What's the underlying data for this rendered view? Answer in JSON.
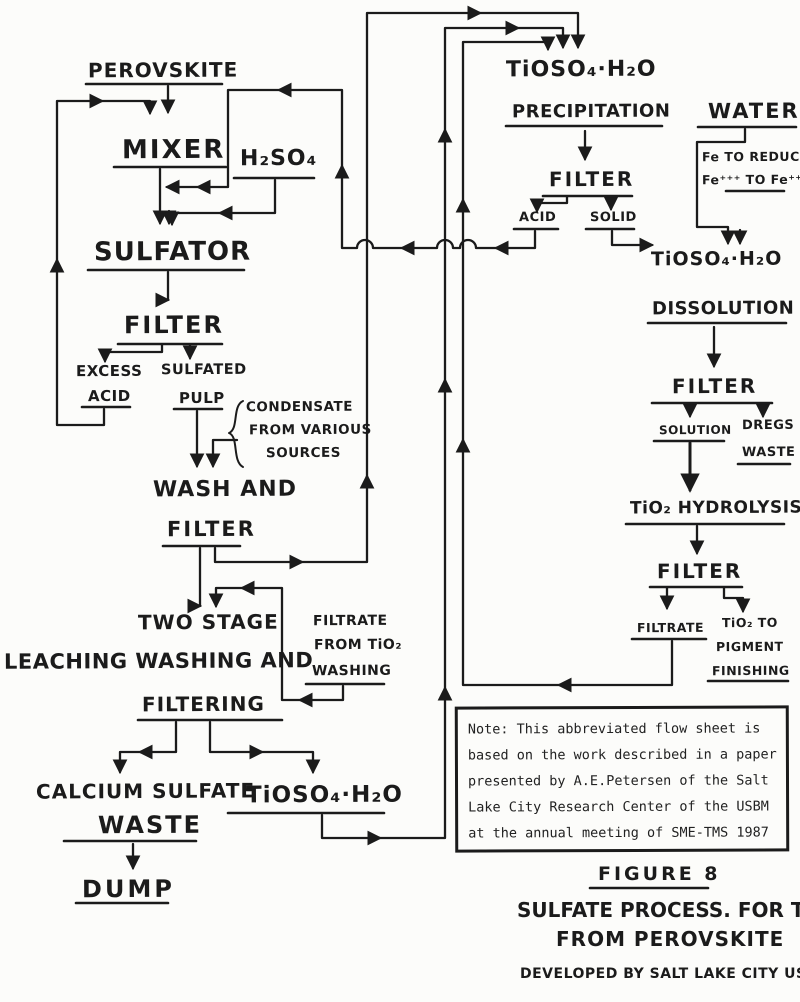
{
  "colors": {
    "ink": "#1b1b1b",
    "paper": "#fcfcfa"
  },
  "nodes": {
    "perovskite": "PEROVSKITE",
    "mixer": "MIXER",
    "h2so4": "H₂SO₄",
    "sulfator": "SULFATOR",
    "filter_sulfator": "FILTER",
    "excess": "EXCESS",
    "excess_acid": "ACID",
    "sulfated": "SULFATED",
    "pulp": "PULP",
    "condensate_1": "CONDENSATE",
    "condensate_2": "FROM VARIOUS",
    "condensate_3": "SOURCES",
    "wash_1": "WASH AND",
    "wash_2": "FILTER",
    "two_stage_1": "TWO STAGE",
    "two_stage_2": "LEACHING WASHING AND",
    "two_stage_3": "FILTERING",
    "filtrate_wash_1": "FILTRATE",
    "filtrate_wash_2": "FROM TiO₂",
    "filtrate_wash_3": "WASHING",
    "calcium_1": "CALCIUM SULFATE",
    "calcium_2": "WASTE",
    "dump": "DUMP",
    "tioso4_leach": "TiOSO₄·H₂O",
    "tioso4_precip_1": "TiOSO₄·H₂O",
    "tioso4_precip_2": "PRECIPITATION",
    "filter_precip": "FILTER",
    "acid_precip": "ACID",
    "solid": "SOLID",
    "water": "WATER",
    "fe_note_1": "Fe TO REDUCE",
    "fe_note_2": "Fe⁺⁺⁺ TO Fe⁺⁺",
    "tioso4_diss_1": "TiOSO₄·H₂O",
    "tioso4_diss_2": "DISSOLUTION",
    "filter_diss": "FILTER",
    "solution": "SOLUTION",
    "dregs_1": "DREGS",
    "dregs_2": "WASTE",
    "hydrolysis": "TiO₂ HYDROLYSIS",
    "filter_hydrolysis": "FILTER",
    "filtrate_hyd": "FILTRATE",
    "pigment_1": "TiO₂ TO",
    "pigment_2": "PIGMENT",
    "pigment_3": "FINISHING"
  },
  "note": {
    "lines": [
      "Note: This abbreviated flow sheet is",
      "based on the work described in a paper",
      "presented by A.E.Petersen of the Salt",
      "Lake City Research Center of the USBM",
      "at the annual meeting of SME-TMS 1987"
    ]
  },
  "figure": {
    "figure_label": "FIGURE 8",
    "title_line1": "SULFATE PROCESS. FOR TiO₂",
    "title_line2": "FROM PEROVSKITE",
    "credit": "DEVELOPED BY SALT LAKE CITY USBM"
  }
}
